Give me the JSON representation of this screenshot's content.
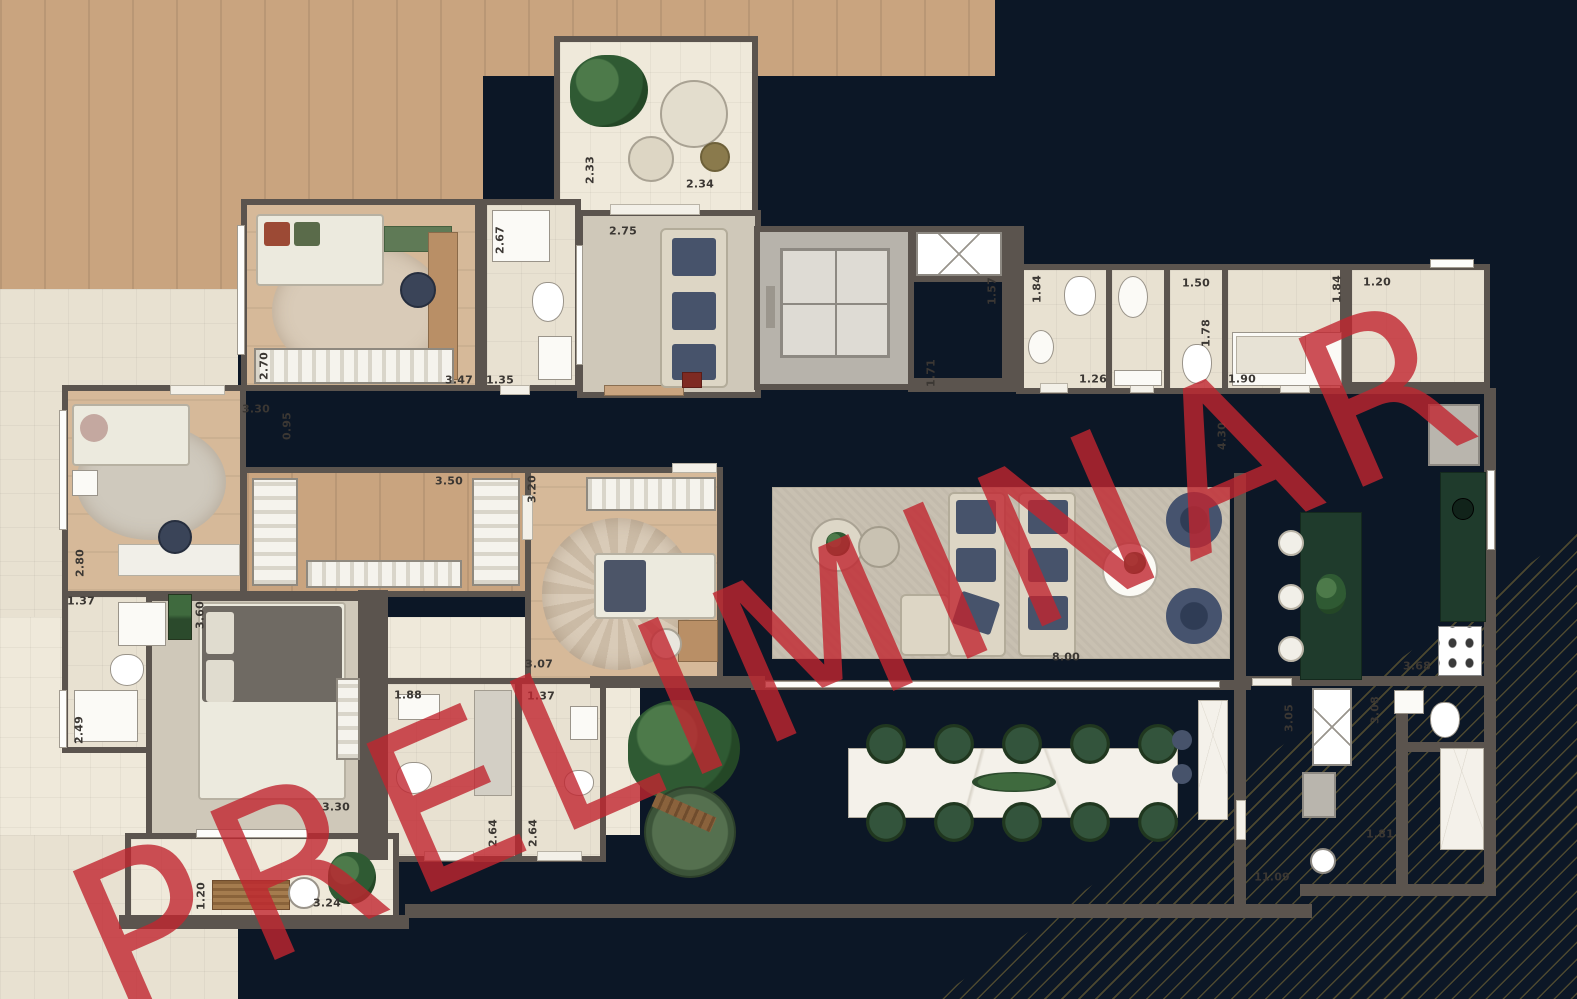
{
  "watermark": {
    "text": "PRELIMINAR",
    "color": "#c1262f"
  },
  "colors": {
    "background": "#0c1726",
    "walls": "#5b544e",
    "floor_tile": "#e8e1d1",
    "floor_wood": "#c9a47f",
    "watermark_red": "#c1262f",
    "gold_lines": "#a98e3c",
    "furniture_navy": "#47536b",
    "furniture_green": "#2e5038",
    "kitchen_counter_green": "#1f3b2c"
  },
  "dimensions": [
    {
      "value": "2.33",
      "x": 590,
      "y": 170,
      "vertical": true
    },
    {
      "value": "2.34",
      "x": 700,
      "y": 184,
      "vertical": false
    },
    {
      "value": "2.75",
      "x": 623,
      "y": 231,
      "vertical": false
    },
    {
      "value": "2.67",
      "x": 500,
      "y": 240,
      "vertical": true
    },
    {
      "value": "2.70",
      "x": 264,
      "y": 366,
      "vertical": true
    },
    {
      "value": "3.47",
      "x": 459,
      "y": 380,
      "vertical": false
    },
    {
      "value": "1.35",
      "x": 500,
      "y": 380,
      "vertical": false
    },
    {
      "value": "3.30",
      "x": 256,
      "y": 409,
      "vertical": false
    },
    {
      "value": "0.95",
      "x": 287,
      "y": 426,
      "vertical": true
    },
    {
      "value": "1.57",
      "x": 992,
      "y": 291,
      "vertical": true
    },
    {
      "value": "1.84",
      "x": 1037,
      "y": 289,
      "vertical": true
    },
    {
      "value": "1.50",
      "x": 1196,
      "y": 283,
      "vertical": false
    },
    {
      "value": "1.84",
      "x": 1337,
      "y": 289,
      "vertical": true
    },
    {
      "value": "1.20",
      "x": 1377,
      "y": 282,
      "vertical": false
    },
    {
      "value": "1.78",
      "x": 1206,
      "y": 333,
      "vertical": true
    },
    {
      "value": "1.71",
      "x": 931,
      "y": 373,
      "vertical": true
    },
    {
      "value": "1.26",
      "x": 1093,
      "y": 379,
      "vertical": false
    },
    {
      "value": "1.90",
      "x": 1242,
      "y": 379,
      "vertical": false
    },
    {
      "value": "4.30",
      "x": 1222,
      "y": 436,
      "vertical": true
    },
    {
      "value": "3.50",
      "x": 449,
      "y": 481,
      "vertical": false
    },
    {
      "value": "3.20",
      "x": 532,
      "y": 489,
      "vertical": true
    },
    {
      "value": "2.80",
      "x": 80,
      "y": 563,
      "vertical": true
    },
    {
      "value": "1.37",
      "x": 81,
      "y": 601,
      "vertical": false
    },
    {
      "value": "3.60",
      "x": 200,
      "y": 615,
      "vertical": true
    },
    {
      "value": "2.49",
      "x": 79,
      "y": 730,
      "vertical": true
    },
    {
      "value": "3.07",
      "x": 539,
      "y": 664,
      "vertical": false
    },
    {
      "value": "1.37",
      "x": 541,
      "y": 696,
      "vertical": false
    },
    {
      "value": "1.88",
      "x": 408,
      "y": 695,
      "vertical": false
    },
    {
      "value": "8.00",
      "x": 1066,
      "y": 657,
      "vertical": false
    },
    {
      "value": "3.68",
      "x": 1417,
      "y": 666,
      "vertical": false
    },
    {
      "value": "3.05",
      "x": 1289,
      "y": 718,
      "vertical": true
    },
    {
      "value": "3.08",
      "x": 1375,
      "y": 710,
      "vertical": true
    },
    {
      "value": "2.64",
      "x": 493,
      "y": 833,
      "vertical": true
    },
    {
      "value": "2.64",
      "x": 533,
      "y": 833,
      "vertical": true
    },
    {
      "value": "3.30",
      "x": 336,
      "y": 807,
      "vertical": false
    },
    {
      "value": "1.81",
      "x": 1380,
      "y": 834,
      "vertical": false
    },
    {
      "value": "1.20",
      "x": 201,
      "y": 896,
      "vertical": true
    },
    {
      "value": "3.24",
      "x": 327,
      "y": 903,
      "vertical": false
    },
    {
      "value": "11.09",
      "x": 1272,
      "y": 877,
      "vertical": false
    }
  ]
}
